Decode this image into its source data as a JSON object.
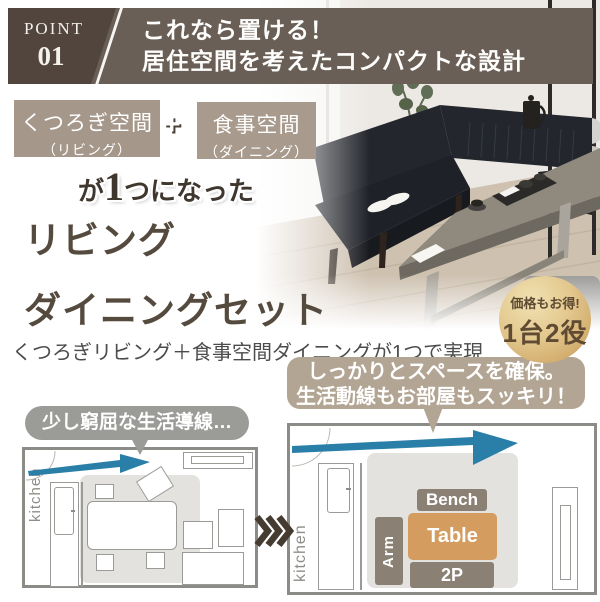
{
  "banner": {
    "point_label": "POINT",
    "point_number": "01",
    "heading_line1": "これなら置ける！",
    "heading_line2": "居住空間を考えたコンパクトな設計",
    "bg_color": "#6a5f56",
    "point_box_color": "#51453d"
  },
  "space_labels": {
    "box1_line1": "くつろぎ空間",
    "box1_line2": "（リビング）",
    "plus": "+",
    "box2_line1": "食事空間",
    "box2_line2": "（ダイニング）",
    "box_color": "#a5978a"
  },
  "merged_line": {
    "prefix": "が",
    "number": "1",
    "suffix": "つになった"
  },
  "title": {
    "line1": "リビング",
    "line2": "ダイニングセット",
    "color": "#554a3e"
  },
  "subtitle": "くつろぎリビング＋食事空間ダイニングが1つで実現",
  "badge": {
    "line1": "価格もお得!",
    "line2": "1台2役",
    "bg_color": "#d9b97c",
    "text_color": "#5f4a33"
  },
  "bubble_right": {
    "line1": "しっかりとスペースを確保。",
    "line2": "生活動線もお部屋もスッキリ！",
    "bg_color": "#b3a593"
  },
  "bubble_left": {
    "text": "少し窮屈な生活導線…",
    "bg_color": "#9b9b98"
  },
  "floor_plans": {
    "left": {
      "kitchen_label": "kitchen"
    },
    "right": {
      "kitchen_label": "kitchen",
      "bench_label": "Bench",
      "table_label": "Table",
      "arm_label": "Arm",
      "sofa2p_label": "2P",
      "bench_color": "#8a8174",
      "table_color": "#d49d5f"
    },
    "arrow_color": "#2a7fa8",
    "chevron_color": "#453b31"
  }
}
